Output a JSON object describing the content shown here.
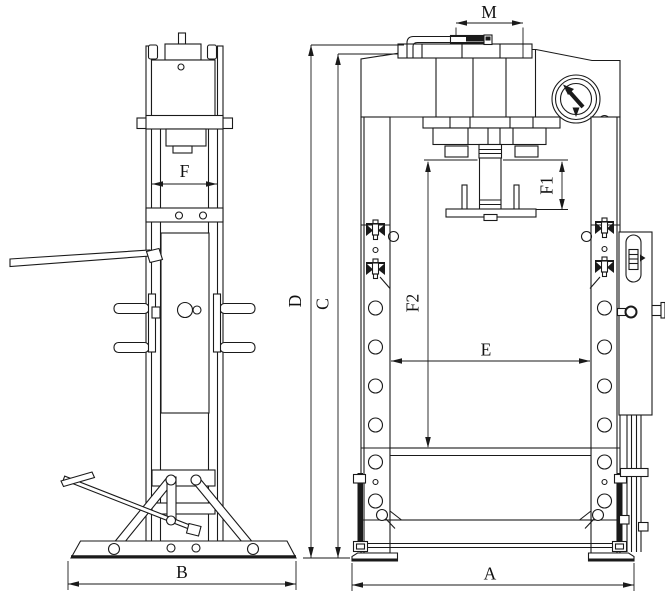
{
  "colors": {
    "line": "#1a1a1a",
    "background": "#ffffff"
  },
  "labels": {
    "ram_width": "F",
    "base_depth": "B",
    "handle_span": "M",
    "overall_height": "D",
    "frame_height": "C",
    "piston_stroke": "F1",
    "working_height": "F2",
    "inner_width": "E",
    "base_width": "A"
  },
  "icons": {
    "pressure_gauge": "pressure-gauge-icon",
    "spring_hook": "spring-hook-icon",
    "pump_handle": "pump-handle",
    "foot_pedal": "foot-pedal-assembly"
  }
}
